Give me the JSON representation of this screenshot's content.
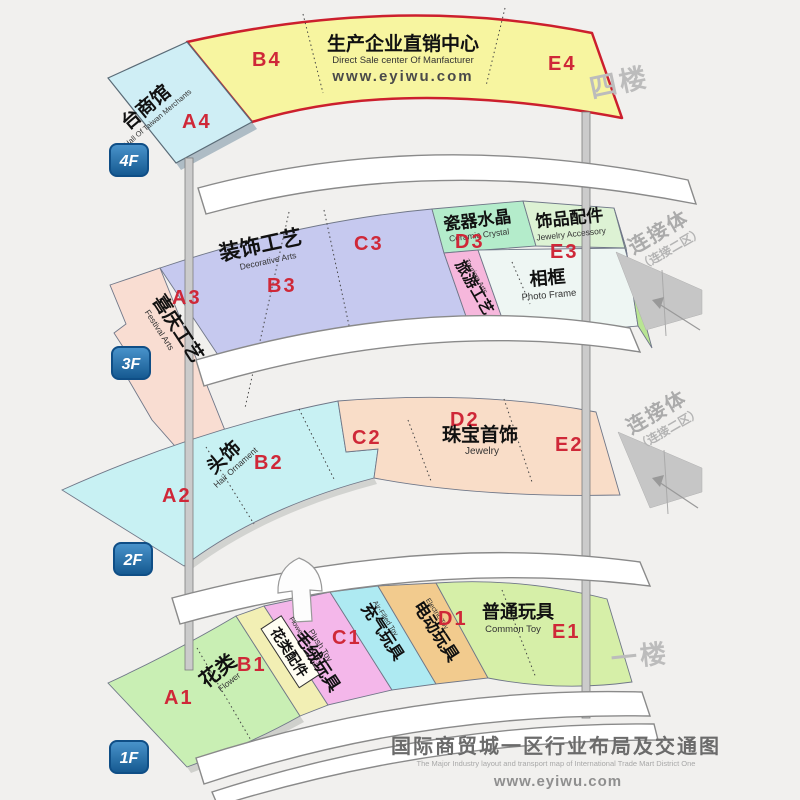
{
  "meta": {
    "bottom_title": "国际商贸城一区行业布局及交通图",
    "bottom_subtitle": "The Major Industry layout and transport map of International Trade Mart District One",
    "site": "www.eyiwu.com"
  },
  "connector": {
    "label": "连接体",
    "sub": "（连接二区）"
  },
  "floors": {
    "f4": {
      "badge": "4F",
      "side_label": "四楼",
      "taiwan": {
        "code": "A4",
        "cn": "台商馆",
        "en": "Hall Of Taiwan Merchants"
      },
      "b4": "B4",
      "e4": "E4",
      "center": {
        "cn": "生产企业直销中心",
        "en": "Direct Sale center Of Manfacturer",
        "web": "www.eyiwu.com"
      }
    },
    "f3": {
      "badge": "3F",
      "festival": {
        "code": "A3",
        "cn": "喜庆工艺",
        "en": "Festival Arts"
      },
      "decorative": {
        "code_b": "B3",
        "code_c": "C3",
        "cn": "装饰工艺",
        "en": "Decorative Arts"
      },
      "ceramic": {
        "code": "D3",
        "cn": "瓷器水晶",
        "en": "Ceramic Crystal"
      },
      "tourism": {
        "cn": "旅游工艺",
        "en": "Tourism Arts"
      },
      "jewelry_accessory": {
        "code": "E3",
        "cn": "饰品配件",
        "en": "Jewelry Accessory"
      },
      "photo_frame": {
        "cn": "相框",
        "en": "Photo Frame"
      }
    },
    "f2": {
      "badge": "2F",
      "hair": {
        "code_a": "A2",
        "code_b": "B2",
        "cn": "头饰",
        "en": "Hair Ornament"
      },
      "jewelry": {
        "code_c": "C2",
        "code_d": "D2",
        "code_e": "E2",
        "cn": "珠宝首饰",
        "en": "Jewelry"
      }
    },
    "f1": {
      "badge": "1F",
      "side_label": "一楼",
      "flower": {
        "code": "A1",
        "cn": "花类",
        "en": "Flower"
      },
      "flower_accessory": {
        "code": "B1",
        "cn": "花类配件",
        "en": "Flower Accessory"
      },
      "plush": {
        "cn": "毛绒玩具",
        "en": "Plush Toy"
      },
      "inflatable": {
        "code": "C1",
        "cn": "充气玩具",
        "en": "Air-Filled Toy"
      },
      "electric": {
        "code": "D1",
        "cn": "电动玩具",
        "en": "Electric Toy"
      },
      "common": {
        "code": "E1",
        "cn": "普通玩具",
        "en": "Common Toy"
      }
    }
  },
  "colors": {
    "zone_code_red": "#cf2838",
    "direct_sale_border_red": "#cc1f2d",
    "badge_blue": "#1e6cb0",
    "gray_label": "#bcbcbc",
    "fills": {
      "taiwan_hall": "#cfeef5",
      "direct_sale": "#f7f5a0",
      "festival_arts": "#f9ddd2",
      "decorative_arts": "#c6c9ef",
      "ceramic_crystal": "#b4eccb",
      "tourism_arts": "#f6b7dc",
      "jewelry_accessory": "#ddf2d4",
      "photo_frame": "#eef6f3",
      "hair_ornament": "#c8f1f3",
      "jewelry": "#f9ddc8",
      "flower": "#c9efb4",
      "flower_accessory": "#f2efb4",
      "plush_toy": "#f4b7ea",
      "air_filled_toy": "#aeeaf2",
      "electric_toy": "#f2cb8e",
      "common_toy": "#d6efa8"
    }
  }
}
